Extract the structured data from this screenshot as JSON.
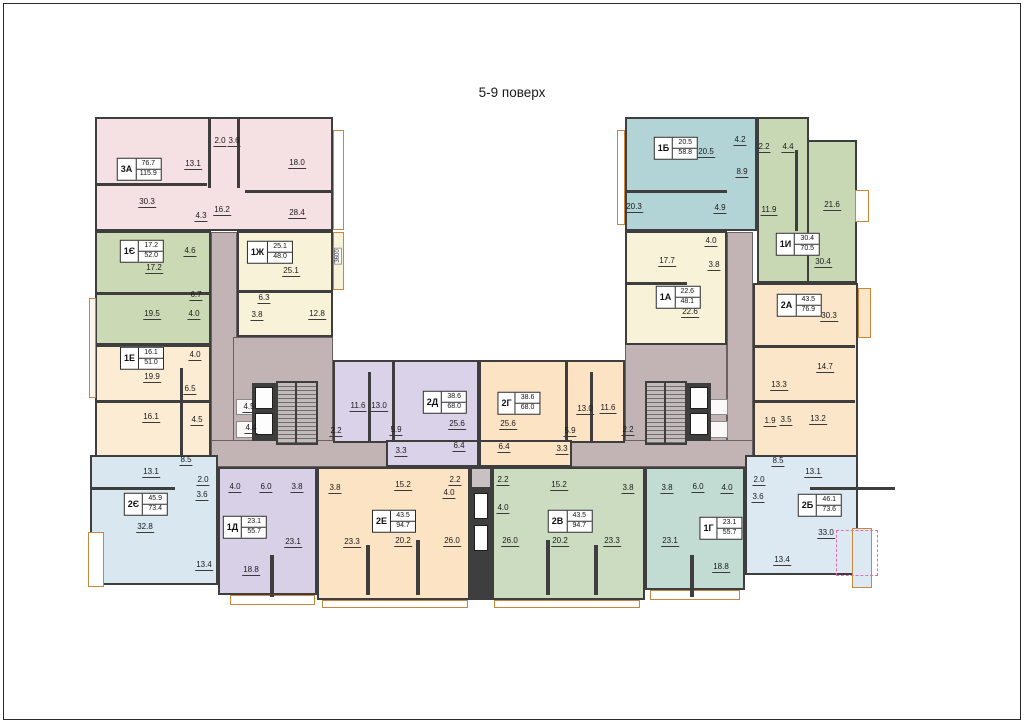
{
  "title": "5-9 поверх",
  "apartments": [
    {
      "id": "3А",
      "live": "76.7",
      "total": "115.9",
      "x": 139,
      "y": 169
    },
    {
      "id": "1Є",
      "live": "17.2",
      "total": "52.0",
      "x": 142,
      "y": 251
    },
    {
      "id": "1Ж",
      "live": "25.1",
      "total": "48.0",
      "x": 270,
      "y": 252
    },
    {
      "id": "1Е",
      "live": "16.1",
      "total": "51.0",
      "x": 142,
      "y": 358
    },
    {
      "id": "2Є",
      "live": "45.9",
      "total": "73.4",
      "x": 146,
      "y": 504
    },
    {
      "id": "1Д",
      "live": "23.1",
      "total": "55.7",
      "x": 245,
      "y": 527
    },
    {
      "id": "2Е",
      "live": "43.5",
      "total": "94.7",
      "x": 394,
      "y": 521
    },
    {
      "id": "2Д",
      "live": "38.6",
      "total": "68.0",
      "x": 445,
      "y": 402
    },
    {
      "id": "2Г",
      "live": "38.6",
      "total": "68.0",
      "x": 519,
      "y": 403
    },
    {
      "id": "2В",
      "live": "43.5",
      "total": "94.7",
      "x": 570,
      "y": 521
    },
    {
      "id": "1Г",
      "live": "23.1",
      "total": "55.7",
      "x": 721,
      "y": 528
    },
    {
      "id": "2Б",
      "live": "46.1",
      "total": "73.6",
      "x": 820,
      "y": 505
    },
    {
      "id": "2А",
      "live": "43.5",
      "total": "76.9",
      "x": 799,
      "y": 305
    },
    {
      "id": "1И",
      "live": "30.4",
      "total": "70.5",
      "x": 798,
      "y": 244
    },
    {
      "id": "1А",
      "live": "22.6",
      "total": "48.1",
      "x": 678,
      "y": 297
    },
    {
      "id": "1Б",
      "live": "20.5",
      "total": "58.8",
      "x": 676,
      "y": 148
    }
  ],
  "area_labels": [
    {
      "v": "2.0",
      "x": 220,
      "y": 142
    },
    {
      "v": "3.6",
      "x": 234,
      "y": 142
    },
    {
      "v": "13.1",
      "x": 193,
      "y": 165
    },
    {
      "v": "18.0",
      "x": 297,
      "y": 164
    },
    {
      "v": "30.3",
      "x": 147,
      "y": 203
    },
    {
      "v": "4.3",
      "x": 201,
      "y": 217
    },
    {
      "v": "16.2",
      "x": 222,
      "y": 211
    },
    {
      "v": "28.4",
      "x": 297,
      "y": 214
    },
    {
      "v": "4.6",
      "x": 190,
      "y": 252
    },
    {
      "v": "17.2",
      "x": 154,
      "y": 269
    },
    {
      "v": "6.7",
      "x": 196,
      "y": 296
    },
    {
      "v": "19.5",
      "x": 152,
      "y": 315
    },
    {
      "v": "4.0",
      "x": 194,
      "y": 315
    },
    {
      "v": "25.1",
      "x": 291,
      "y": 272
    },
    {
      "v": "6.3",
      "x": 264,
      "y": 299
    },
    {
      "v": "3.8",
      "x": 257,
      "y": 316
    },
    {
      "v": "12.8",
      "x": 317,
      "y": 315
    },
    {
      "v": "4.0",
      "x": 195,
      "y": 356
    },
    {
      "v": "19.9",
      "x": 152,
      "y": 378
    },
    {
      "v": "6.5",
      "x": 190,
      "y": 390
    },
    {
      "v": "16.1",
      "x": 151,
      "y": 418
    },
    {
      "v": "4.5",
      "x": 197,
      "y": 421
    },
    {
      "v": "4.5",
      "x": 249,
      "y": 408
    },
    {
      "v": "4.4",
      "x": 251,
      "y": 429
    },
    {
      "v": "11.6",
      "x": 358,
      "y": 407
    },
    {
      "v": "13.0",
      "x": 379,
      "y": 407
    },
    {
      "v": "2.2",
      "x": 336,
      "y": 432
    },
    {
      "v": "5.9",
      "x": 396,
      "y": 431
    },
    {
      "v": "3.3",
      "x": 401,
      "y": 452
    },
    {
      "v": "25.6",
      "x": 457,
      "y": 425
    },
    {
      "v": "6.4",
      "x": 459,
      "y": 447
    },
    {
      "v": "25.6",
      "x": 508,
      "y": 425
    },
    {
      "v": "6.4",
      "x": 504,
      "y": 448
    },
    {
      "v": "5.9",
      "x": 570,
      "y": 432
    },
    {
      "v": "3.3",
      "x": 562,
      "y": 450
    },
    {
      "v": "13.0",
      "x": 585,
      "y": 410
    },
    {
      "v": "11.6",
      "x": 608,
      "y": 409
    },
    {
      "v": "2.2",
      "x": 628,
      "y": 431
    },
    {
      "v": "8.5",
      "x": 186,
      "y": 461
    },
    {
      "v": "13.1",
      "x": 151,
      "y": 473
    },
    {
      "v": "2.0",
      "x": 203,
      "y": 481
    },
    {
      "v": "3.6",
      "x": 202,
      "y": 496
    },
    {
      "v": "32.8",
      "x": 145,
      "y": 528
    },
    {
      "v": "13.4",
      "x": 204,
      "y": 566
    },
    {
      "v": "4.0",
      "x": 235,
      "y": 488
    },
    {
      "v": "6.0",
      "x": 266,
      "y": 488
    },
    {
      "v": "3.8",
      "x": 297,
      "y": 488
    },
    {
      "v": "3.8",
      "x": 335,
      "y": 489
    },
    {
      "v": "23.1",
      "x": 293,
      "y": 543
    },
    {
      "v": "18.8",
      "x": 251,
      "y": 571
    },
    {
      "v": "15.2",
      "x": 403,
      "y": 486
    },
    {
      "v": "2.2",
      "x": 455,
      "y": 481
    },
    {
      "v": "4.0",
      "x": 449,
      "y": 494
    },
    {
      "v": "23.3",
      "x": 352,
      "y": 543
    },
    {
      "v": "20.2",
      "x": 403,
      "y": 542
    },
    {
      "v": "26.0",
      "x": 452,
      "y": 542
    },
    {
      "v": "2.2",
      "x": 503,
      "y": 481
    },
    {
      "v": "4.0",
      "x": 503,
      "y": 509
    },
    {
      "v": "15.2",
      "x": 559,
      "y": 486
    },
    {
      "v": "26.0",
      "x": 510,
      "y": 542
    },
    {
      "v": "20.2",
      "x": 560,
      "y": 542
    },
    {
      "v": "23.3",
      "x": 612,
      "y": 542
    },
    {
      "v": "3.8",
      "x": 628,
      "y": 489
    },
    {
      "v": "3.8",
      "x": 667,
      "y": 489
    },
    {
      "v": "6.0",
      "x": 698,
      "y": 488
    },
    {
      "v": "4.0",
      "x": 727,
      "y": 489
    },
    {
      "v": "23.1",
      "x": 670,
      "y": 542
    },
    {
      "v": "18.8",
      "x": 721,
      "y": 568
    },
    {
      "v": "8.5",
      "x": 778,
      "y": 462
    },
    {
      "v": "13.1",
      "x": 813,
      "y": 473
    },
    {
      "v": "2.0",
      "x": 759,
      "y": 481
    },
    {
      "v": "3.6",
      "x": 758,
      "y": 498
    },
    {
      "v": "33.0",
      "x": 826,
      "y": 534
    },
    {
      "v": "13.4",
      "x": 782,
      "y": 561
    },
    {
      "v": "20.5",
      "x": 706,
      "y": 153
    },
    {
      "v": "4.2",
      "x": 740,
      "y": 141
    },
    {
      "v": "8.9",
      "x": 742,
      "y": 173
    },
    {
      "v": "20.3",
      "x": 634,
      "y": 208
    },
    {
      "v": "4.9",
      "x": 720,
      "y": 209
    },
    {
      "v": "2.2",
      "x": 764,
      "y": 148
    },
    {
      "v": "4.4",
      "x": 788,
      "y": 148
    },
    {
      "v": "11.9",
      "x": 769,
      "y": 211
    },
    {
      "v": "21.6",
      "x": 832,
      "y": 206
    },
    {
      "v": "30.4",
      "x": 823,
      "y": 263
    },
    {
      "v": "17.7",
      "x": 667,
      "y": 262
    },
    {
      "v": "4.0",
      "x": 711,
      "y": 242
    },
    {
      "v": "3.8",
      "x": 714,
      "y": 266
    },
    {
      "v": "22.6",
      "x": 690,
      "y": 313
    },
    {
      "v": "30.3",
      "x": 829,
      "y": 317
    },
    {
      "v": "14.7",
      "x": 825,
      "y": 368
    },
    {
      "v": "13.3",
      "x": 779,
      "y": 386
    },
    {
      "v": "13.2",
      "x": 818,
      "y": 420
    },
    {
      "v": "1.9",
      "x": 770,
      "y": 422
    },
    {
      "v": "3.5",
      "x": 786,
      "y": 421
    }
  ],
  "dimensions": [
    {
      "v": "3600",
      "x": 338,
      "y": 256
    }
  ]
}
